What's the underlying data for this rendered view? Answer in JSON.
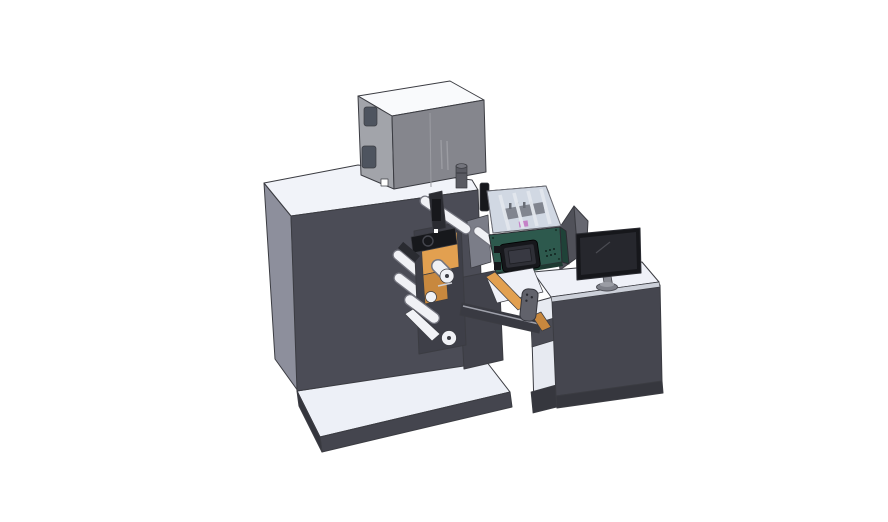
{
  "scene": {
    "type": "3d-cad-render",
    "description": "Isometric CAD rendering of an industrial label printing and rewinding machine: main cabinet with printer housing on top, rewind roller station, teal print module with HMI panel under a transparent cover, transfer conveyor, and an operator desk with a monitor.",
    "background": "#ffffff",
    "canvas_width": 888,
    "canvas_height": 522
  },
  "parts": {
    "platform": "machine base platform",
    "cabinet": "main machine cabinet",
    "printer_box": "printer housing unit",
    "cylinder": "cylinder fitting on cabinet top",
    "rewind": "rewind station with orange turret and guide rollers",
    "print_module": "print module with transparent cover and HMI panel",
    "conveyor": "transfer conveyor and stand",
    "guard": "sheet-metal deflector guard",
    "desk": "operator control desk",
    "monitor": "operator monitor on stand"
  },
  "colors": {
    "edge": "#3b3c42",
    "cabinet_front": "#4b4c56",
    "cabinet_side": "#8d8f9c",
    "cabinet_top": "#f1f3f9",
    "cabinet_dots": "#70717a",
    "platform_top": "#edf0f7",
    "platform_front": "#44454e",
    "platform_side": "#34353d",
    "box_top": "#f9fafc",
    "box_left": "#a2a4aa",
    "box_front": "#85868d",
    "box_seam": "#9b9ca2",
    "box_hinge": "#4e545f",
    "box_mark": "#ffffff",
    "cylinder_body": "#595a62",
    "cylinder_top": "#73747c",
    "cylinder_band": "#44454c",
    "pillar": "#3e3f48",
    "column": "#42434c",
    "wedge": "#7b7d88",
    "orange": "#e2a050",
    "orange_dark": "#c8883e",
    "roller_body": "#f0f1f5",
    "roller_edge": "#73747e",
    "roller_core": "#3c3d44",
    "tray": "#f2f3f7",
    "mech": "#17181c",
    "mech_mid": "#2a2b31",
    "mech_dash": "#cfd0d6",
    "teal": "#2d594d",
    "teal_dark": "#1f4238",
    "teal_lip": "#1d3a31",
    "cover_rim": "#4a5452",
    "glass_base": "#d9dfe9",
    "glass": "#c0c9d8",
    "glass_rib": "#f4f6f9",
    "carriage": "#64656e",
    "teeth": "#3f4047",
    "magenta": "#c75fc0",
    "hmi_body": "#16171b",
    "hmi_bezel": "#2e2f36",
    "hmi_screen": "#383942",
    "vent_dot": "#11231e",
    "screw_dot": "#1b352c",
    "desk_front": "#45464f",
    "desk_top": "#eff1f8",
    "desk_side": "#e7eaf1",
    "desk_band": "#4a4b54",
    "desk_plinth": "#36373e",
    "desk_lip": "#ccd0d9",
    "guard_dark": "#505159",
    "guard_light": "#666770",
    "monitor_bezel": "#16171b",
    "monitor_screen": "#26272d",
    "monitor_line": "#4a4b52",
    "stand": "#8a8c94",
    "stand_base": "#7d7f88",
    "stand_base_top": "#9a9ca4",
    "beam": "#393a42",
    "beam_hi": "#9fa1ab",
    "bracket": "#61626b",
    "bracket_dot": "#2a2b31",
    "white": "#ffffff"
  }
}
